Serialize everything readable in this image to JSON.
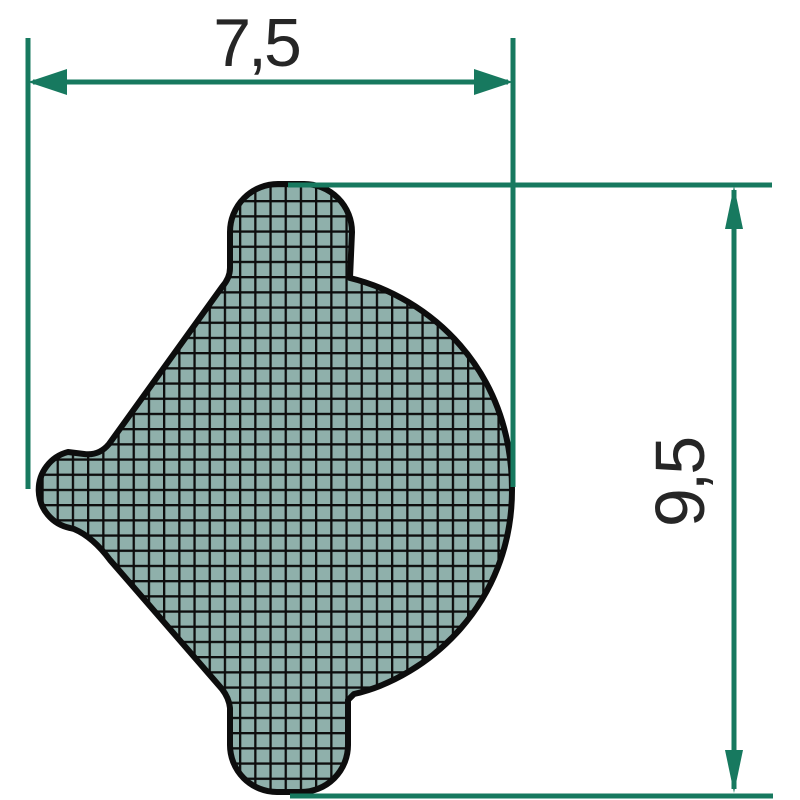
{
  "diagram": {
    "width_dimension": {
      "label": "7,5"
    },
    "height_dimension": {
      "label": "9,5"
    },
    "colors": {
      "dimension_line": "#17795F",
      "profile_fill": "#8FB0AB",
      "profile_outline": "#0D0D0D",
      "label_text": "#262626",
      "background": "#FFFFFF"
    }
  }
}
